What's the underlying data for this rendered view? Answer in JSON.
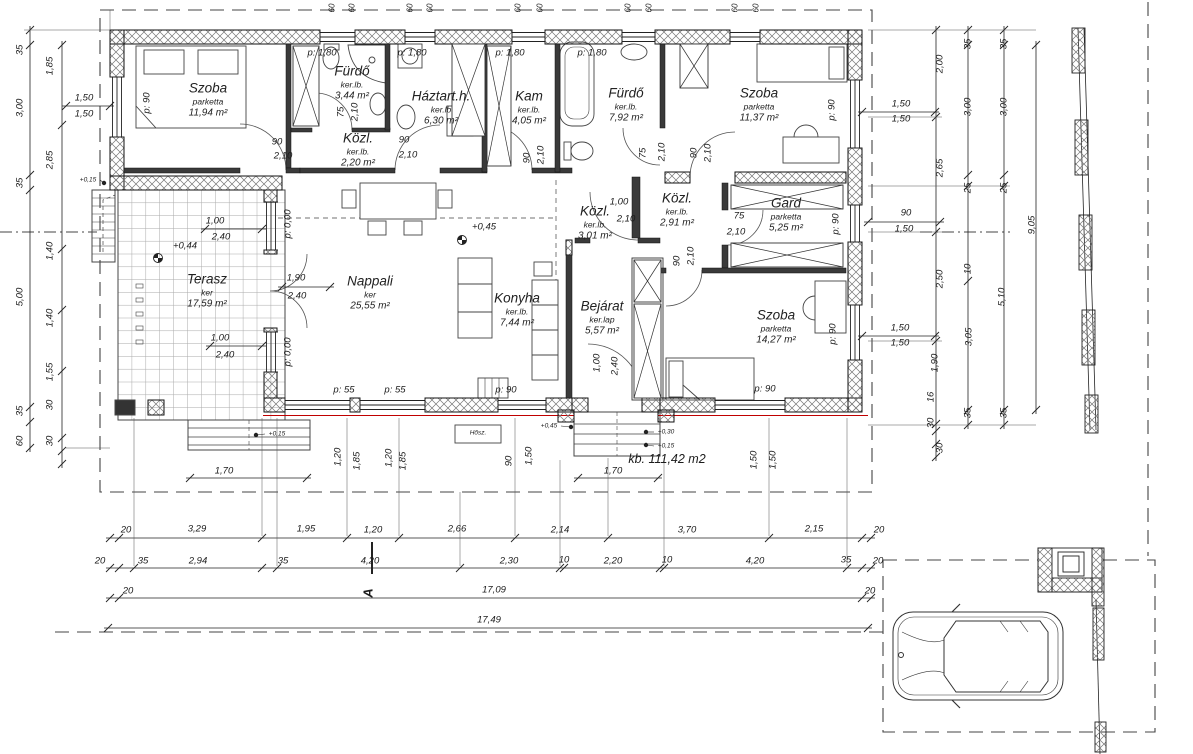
{
  "drawing": {
    "type": "house floor plan",
    "total_area": "kb. 111,42 m2",
    "section_marker": "A"
  },
  "rooms": [
    {
      "name": "Szoba",
      "finish": "parketta",
      "area": "11,94 m²",
      "x": 208,
      "y": 100
    },
    {
      "name": "Fürdő",
      "finish": "ker.lb.",
      "area": "3,44 m²",
      "x": 352,
      "y": 83
    },
    {
      "name": "Közl.",
      "finish": "ker.lb.",
      "area": "2,20 m²",
      "x": 358,
      "y": 150
    },
    {
      "name": "Háztart.h.",
      "finish": "ker.lb",
      "area": "6,30 m²",
      "x": 441,
      "y": 108
    },
    {
      "name": "Kam",
      "finish": "ker.lb.",
      "area": "4,05 m²",
      "x": 529,
      "y": 108
    },
    {
      "name": "Fürdő",
      "finish": "ker.lb.",
      "area": "7,92 m²",
      "x": 626,
      "y": 105
    },
    {
      "name": "Szoba",
      "finish": "parketta",
      "area": "11,37 m²",
      "x": 759,
      "y": 105
    },
    {
      "name": "Közl.",
      "finish": "ker.lb.",
      "area": "3,01 m²",
      "x": 595,
      "y": 223
    },
    {
      "name": "Közl.",
      "finish": "ker.lb.",
      "area": "2,91 m²",
      "x": 677,
      "y": 210
    },
    {
      "name": "Gard",
      "finish": "parketta",
      "area": "5,25 m²",
      "x": 786,
      "y": 215
    },
    {
      "name": "Terasz",
      "finish": "ker",
      "area": "17,59 m²",
      "x": 207,
      "y": 291
    },
    {
      "name": "Nappali",
      "finish": "ker",
      "area": "25,55 m²",
      "x": 370,
      "y": 293
    },
    {
      "name": "Konyha",
      "finish": "ker.lb.",
      "area": "7,44 m²",
      "x": 517,
      "y": 310
    },
    {
      "name": "Bejárat",
      "finish": "ker.lap",
      "area": "5,57 m²",
      "x": 602,
      "y": 318
    },
    {
      "name": "Szoba",
      "finish": "parketta",
      "area": "14,27 m²",
      "x": 776,
      "y": 327
    }
  ],
  "levels": [
    {
      "text": "+0,45",
      "x": 484,
      "y": 227,
      "sx": 462,
      "sy": 240,
      "s": "lvl"
    },
    {
      "text": "+0,44",
      "x": 185,
      "y": 246,
      "sx": 158,
      "sy": 258,
      "s": "lvl"
    },
    {
      "text": "+0,15",
      "x": 88,
      "y": 180,
      "sx": 104,
      "sy": 183,
      "s": "tiny"
    },
    {
      "text": "+0,45",
      "x": 549,
      "y": 426,
      "sx": 571,
      "sy": 427,
      "s": "tiny"
    },
    {
      "text": "+0,30",
      "x": 666,
      "y": 432,
      "sx": 646,
      "sy": 432,
      "s": "tiny"
    },
    {
      "text": "+0,15",
      "x": 666,
      "y": 446,
      "sx": 646,
      "sy": 445,
      "s": "tiny"
    },
    {
      "text": "+0,15",
      "x": 277,
      "y": 434,
      "sx": 256,
      "sy": 435,
      "s": "tiny"
    }
  ],
  "dims": [
    {
      "t": "60",
      "x": 332,
      "y": 8,
      "r": 1,
      "s": "sm"
    },
    {
      "t": "60",
      "x": 352,
      "y": 8,
      "r": 1,
      "s": "sm"
    },
    {
      "t": "60",
      "x": 410,
      "y": 8,
      "r": 1,
      "s": "sm"
    },
    {
      "t": "60",
      "x": 430,
      "y": 8,
      "r": 1,
      "s": "sm"
    },
    {
      "t": "60",
      "x": 518,
      "y": 8,
      "r": 1,
      "s": "sm"
    },
    {
      "t": "60",
      "x": 540,
      "y": 8,
      "r": 1,
      "s": "sm"
    },
    {
      "t": "60",
      "x": 628,
      "y": 8,
      "r": 1,
      "s": "sm"
    },
    {
      "t": "60",
      "x": 649,
      "y": 8,
      "r": 1,
      "s": "sm"
    },
    {
      "t": "60",
      "x": 735,
      "y": 8,
      "r": 1,
      "s": "sm"
    },
    {
      "t": "60",
      "x": 756,
      "y": 8,
      "r": 1,
      "s": "sm"
    },
    {
      "t": "p: 1,80",
      "x": 322,
      "y": 53
    },
    {
      "t": "p: 1,80",
      "x": 412,
      "y": 53
    },
    {
      "t": "p: 1,80",
      "x": 510,
      "y": 53
    },
    {
      "t": "p: 1,80",
      "x": 592,
      "y": 53
    },
    {
      "t": "p: 90",
      "x": 147,
      "y": 103,
      "r": 1
    },
    {
      "t": "p: 90",
      "x": 832,
      "y": 110,
      "r": 1
    },
    {
      "t": "p: 90",
      "x": 836,
      "y": 224,
      "r": 1
    },
    {
      "t": "p: 90",
      "x": 833,
      "y": 334,
      "r": 1
    },
    {
      "t": "p: 0,00",
      "x": 288,
      "y": 224,
      "r": 1
    },
    {
      "t": "p: 0,00",
      "x": 288,
      "y": 352,
      "r": 1
    },
    {
      "t": "p: 55",
      "x": 344,
      "y": 390
    },
    {
      "t": "p: 55",
      "x": 395,
      "y": 390
    },
    {
      "t": "p: 90",
      "x": 506,
      "y": 390
    },
    {
      "t": "p: 90",
      "x": 765,
      "y": 389
    },
    {
      "t": "1,50",
      "x": 84,
      "y": 98
    },
    {
      "t": "1,50",
      "x": 84,
      "y": 114
    },
    {
      "t": "1,50",
      "x": 901,
      "y": 104
    },
    {
      "t": "1,50",
      "x": 901,
      "y": 119
    },
    {
      "t": "90",
      "x": 906,
      "y": 213
    },
    {
      "t": "1,50",
      "x": 904,
      "y": 229
    },
    {
      "t": "1,50",
      "x": 900,
      "y": 328
    },
    {
      "t": "1,50",
      "x": 900,
      "y": 343
    },
    {
      "t": "1,00",
      "x": 215,
      "y": 221
    },
    {
      "t": "2,40",
      "x": 221,
      "y": 237
    },
    {
      "t": "1,00",
      "x": 220,
      "y": 338
    },
    {
      "t": "2,40",
      "x": 225,
      "y": 355
    },
    {
      "t": "1,90",
      "x": 296,
      "y": 278
    },
    {
      "t": "2,40",
      "x": 297,
      "y": 296
    },
    {
      "t": "90",
      "x": 277,
      "y": 142
    },
    {
      "t": "2,10",
      "x": 283,
      "y": 156
    },
    {
      "t": "75",
      "x": 341,
      "y": 112,
      "r": 1
    },
    {
      "t": "2,10",
      "x": 355,
      "y": 112,
      "r": 1
    },
    {
      "t": "90",
      "x": 404,
      "y": 140
    },
    {
      "t": "2,10",
      "x": 408,
      "y": 155
    },
    {
      "t": "90",
      "x": 527,
      "y": 158,
      "r": 1
    },
    {
      "t": "2,10",
      "x": 541,
      "y": 155,
      "r": 1
    },
    {
      "t": "75",
      "x": 643,
      "y": 153,
      "r": 1
    },
    {
      "t": "2,10",
      "x": 662,
      "y": 152,
      "r": 1
    },
    {
      "t": "90",
      "x": 694,
      "y": 153,
      "r": 1
    },
    {
      "t": "2,10",
      "x": 708,
      "y": 153,
      "r": 1
    },
    {
      "t": "1,00",
      "x": 619,
      "y": 202
    },
    {
      "t": "2,10",
      "x": 626,
      "y": 219
    },
    {
      "t": "75",
      "x": 739,
      "y": 216
    },
    {
      "t": "2,10",
      "x": 736,
      "y": 232
    },
    {
      "t": "90",
      "x": 677,
      "y": 261,
      "r": 1
    },
    {
      "t": "2,10",
      "x": 691,
      "y": 256,
      "r": 1
    },
    {
      "t": "1,00",
      "x": 597,
      "y": 363,
      "r": 1
    },
    {
      "t": "2,40",
      "x": 615,
      "y": 366,
      "r": 1
    },
    {
      "t": "1,20",
      "x": 338,
      "y": 457,
      "r": 1
    },
    {
      "t": "1,85",
      "x": 357,
      "y": 461,
      "r": 1
    },
    {
      "t": "1,20",
      "x": 389,
      "y": 458,
      "r": 1
    },
    {
      "t": "1,85",
      "x": 403,
      "y": 461,
      "r": 1
    },
    {
      "t": "90",
      "x": 509,
      "y": 461,
      "r": 1
    },
    {
      "t": "1,50",
      "x": 529,
      "y": 456,
      "r": 1
    },
    {
      "t": "1,50",
      "x": 754,
      "y": 460,
      "r": 1
    },
    {
      "t": "1,50",
      "x": 773,
      "y": 460,
      "r": 1
    },
    {
      "t": "1,70",
      "x": 224,
      "y": 471
    },
    {
      "t": "1,70",
      "x": 613,
      "y": 471
    },
    {
      "t": "Hősz.",
      "x": 478,
      "y": 433,
      "s": "tiny"
    },
    {
      "t": "20",
      "x": 126,
      "y": 530
    },
    {
      "t": "3,29",
      "x": 197,
      "y": 529
    },
    {
      "t": "1,95",
      "x": 306,
      "y": 529
    },
    {
      "t": "1,20",
      "x": 373,
      "y": 530
    },
    {
      "t": "2,66",
      "x": 457,
      "y": 529
    },
    {
      "t": "2,14",
      "x": 560,
      "y": 530
    },
    {
      "t": "3,70",
      "x": 687,
      "y": 530
    },
    {
      "t": "2,15",
      "x": 814,
      "y": 529
    },
    {
      "t": "20",
      "x": 879,
      "y": 530
    },
    {
      "t": "20",
      "x": 100,
      "y": 561
    },
    {
      "t": "35",
      "x": 143,
      "y": 561
    },
    {
      "t": "2,94",
      "x": 198,
      "y": 561
    },
    {
      "t": "35",
      "x": 283,
      "y": 561
    },
    {
      "t": "4,20",
      "x": 370,
      "y": 561
    },
    {
      "t": "2,30",
      "x": 509,
      "y": 561
    },
    {
      "t": "10",
      "x": 564,
      "y": 560
    },
    {
      "t": "2,20",
      "x": 613,
      "y": 561
    },
    {
      "t": "10",
      "x": 667,
      "y": 560
    },
    {
      "t": "4,20",
      "x": 755,
      "y": 561
    },
    {
      "t": "35",
      "x": 846,
      "y": 560
    },
    {
      "t": "20",
      "x": 878,
      "y": 561
    },
    {
      "t": "20",
      "x": 128,
      "y": 591
    },
    {
      "t": "17,09",
      "x": 494,
      "y": 590
    },
    {
      "t": "20",
      "x": 870,
      "y": 591
    },
    {
      "t": "17,49",
      "x": 489,
      "y": 620
    },
    {
      "t": "35",
      "x": 20,
      "y": 50,
      "r": 1
    },
    {
      "t": "3,00",
      "x": 20,
      "y": 108,
      "r": 1
    },
    {
      "t": "35",
      "x": 20,
      "y": 183,
      "r": 1
    },
    {
      "t": "5,00",
      "x": 20,
      "y": 297,
      "r": 1
    },
    {
      "t": "35",
      "x": 20,
      "y": 411,
      "r": 1
    },
    {
      "t": "60",
      "x": 20,
      "y": 441,
      "r": 1
    },
    {
      "t": "1,85",
      "x": 50,
      "y": 66,
      "r": 1
    },
    {
      "t": "2,85",
      "x": 50,
      "y": 160,
      "r": 1
    },
    {
      "t": "1,40",
      "x": 50,
      "y": 251,
      "r": 1
    },
    {
      "t": "1,40",
      "x": 50,
      "y": 318,
      "r": 1
    },
    {
      "t": "1,55",
      "x": 50,
      "y": 372,
      "r": 1
    },
    {
      "t": "30",
      "x": 50,
      "y": 405,
      "r": 1
    },
    {
      "t": "30",
      "x": 50,
      "y": 441,
      "r": 1
    },
    {
      "t": "2,00",
      "x": 940,
      "y": 64,
      "r": 1
    },
    {
      "t": "2,65",
      "x": 940,
      "y": 168,
      "r": 1
    },
    {
      "t": "2,50",
      "x": 940,
      "y": 279,
      "r": 1
    },
    {
      "t": "1,90",
      "x": 935,
      "y": 363,
      "r": 1
    },
    {
      "t": "16",
      "x": 931,
      "y": 397,
      "r": 1
    },
    {
      "t": "30",
      "x": 931,
      "y": 423,
      "r": 1
    },
    {
      "t": "30",
      "x": 940,
      "y": 448,
      "r": 1
    },
    {
      "t": "35",
      "x": 968,
      "y": 44,
      "r": 1
    },
    {
      "t": "3,00",
      "x": 968,
      "y": 107,
      "r": 1
    },
    {
      "t": "25",
      "x": 968,
      "y": 188,
      "r": 1
    },
    {
      "t": "10",
      "x": 968,
      "y": 269,
      "r": 1
    },
    {
      "t": "3,05",
      "x": 969,
      "y": 337,
      "r": 1
    },
    {
      "t": "35",
      "x": 968,
      "y": 413,
      "r": 1
    },
    {
      "t": "35",
      "x": 1004,
      "y": 44,
      "r": 1
    },
    {
      "t": "3,00",
      "x": 1004,
      "y": 107,
      "r": 1
    },
    {
      "t": "25",
      "x": 1004,
      "y": 188,
      "r": 1
    },
    {
      "t": "5,10",
      "x": 1002,
      "y": 297,
      "r": 1
    },
    {
      "t": "35",
      "x": 1004,
      "y": 413,
      "r": 1
    },
    {
      "t": "9,05",
      "x": 1032,
      "y": 225,
      "r": 1
    }
  ],
  "chains": [
    {
      "dir": "h",
      "pos": 538,
      "ticks": [
        110,
        119,
        262,
        347,
        399,
        515,
        608,
        769,
        862,
        871
      ]
    },
    {
      "dir": "h",
      "pos": 568,
      "ticks": [
        110,
        119,
        134,
        262,
        277,
        460,
        560,
        564,
        660,
        664,
        847,
        862,
        871
      ]
    },
    {
      "dir": "h",
      "pos": 598,
      "ticks": [
        110,
        119,
        862,
        871
      ]
    },
    {
      "dir": "h",
      "pos": 628,
      "ticks": [
        108,
        868
      ]
    },
    {
      "dir": "v",
      "pos": 30,
      "ticks": [
        30,
        45,
        175,
        190,
        407,
        422,
        448
      ]
    },
    {
      "dir": "v",
      "pos": 62,
      "ticks": [
        45,
        125,
        249,
        310,
        371,
        438,
        451,
        464
      ]
    },
    {
      "dir": "v",
      "pos": 936,
      "ticks": [
        30,
        117,
        232,
        341,
        424,
        431,
        444,
        457
      ]
    },
    {
      "dir": "v",
      "pos": 968,
      "ticks": [
        30,
        45,
        175,
        186,
        281,
        410,
        425
      ]
    },
    {
      "dir": "v",
      "pos": 1004,
      "ticks": [
        30,
        45,
        175,
        186,
        410,
        425
      ]
    },
    {
      "dir": "v",
      "pos": 1036,
      "ticks": [
        45,
        410
      ]
    },
    {
      "dir": "h",
      "pos": 478,
      "ticks": [
        190,
        307
      ]
    },
    {
      "dir": "h",
      "pos": 478,
      "ticks": [
        578,
        658
      ]
    },
    {
      "dir": "h",
      "pos": 106,
      "ticks": [
        66,
        110
      ]
    },
    {
      "dir": "h",
      "pos": 222,
      "ticks": [
        868,
        940
      ]
    },
    {
      "dir": "h",
      "pos": 336,
      "ticks": [
        862,
        935
      ]
    },
    {
      "dir": "h",
      "pos": 112,
      "ticks": [
        862,
        935
      ]
    },
    {
      "dir": "h",
      "pos": 229,
      "ticks": [
        205,
        262
      ]
    },
    {
      "dir": "h",
      "pos": 346,
      "ticks": [
        210,
        262
      ]
    },
    {
      "dir": "h",
      "pos": 287,
      "ticks": [
        282,
        330
      ]
    }
  ]
}
